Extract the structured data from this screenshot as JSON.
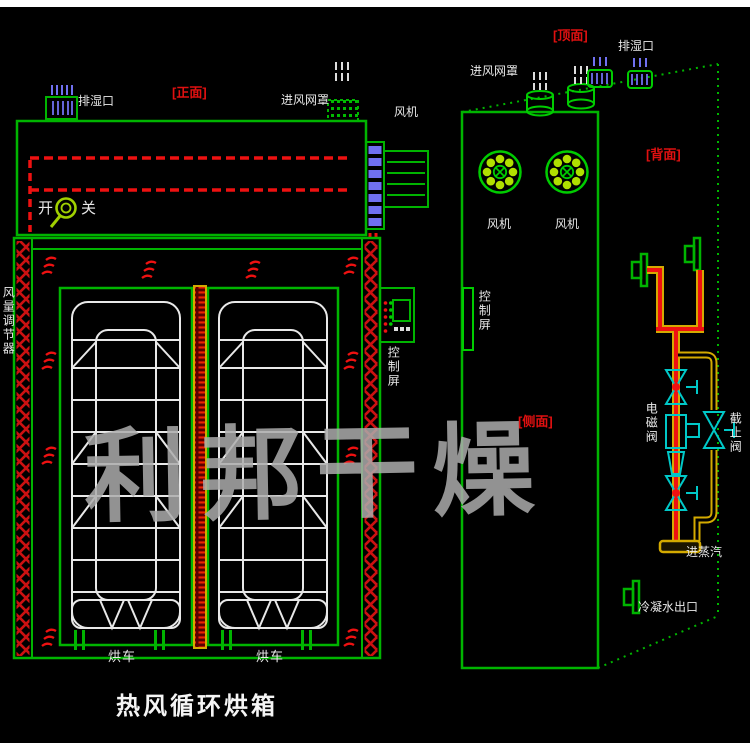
{
  "title": "热风循环烘箱",
  "watermark": "利邦干燥",
  "colors": {
    "background": "#000000",
    "line_green": "#00b400",
    "bright_green": "#00cc00",
    "label_red": "#e01010",
    "dash_red": "#ee1111",
    "vent_blue": "#7070f0",
    "valve_cyan": "#00c8c8",
    "pipe_yellow": "#d4aa00",
    "text_white": "#e8e8e8",
    "watermark_gray": "#acacac"
  },
  "icons": {
    "switch_indicator": "magnifier-icon",
    "fan_symbol": "fan-rosette-icon",
    "valve_symbol": "bowtie-valve-icon",
    "flange_symbol": "pipe-flange-icon"
  },
  "front_view": {
    "face_label": "[正面]",
    "moist_outlet": "排湿口",
    "air_inlet_mesh": "进风网罩",
    "fan": "风机",
    "switch_on": "开",
    "switch_off": "关",
    "air_damper": "风量调节器",
    "control_panel": "控制屏",
    "cart_left": "烘车",
    "cart_right": "烘车",
    "caption": "热风循环烘箱"
  },
  "iso_view": {
    "top_label": "[顶面]",
    "back_label": "[背面]",
    "side_label": "[侧面]",
    "moist_outlet": "排湿口",
    "air_inlet_mesh": "进风网罩",
    "fan_left": "风机",
    "fan_right": "风机",
    "control_panel": "控制屏",
    "solenoid_valve": "电磁阀",
    "stop_valve": "截止阀",
    "steam_inlet": "进蒸汽",
    "condensate_outlet": "冷凝水出口"
  }
}
